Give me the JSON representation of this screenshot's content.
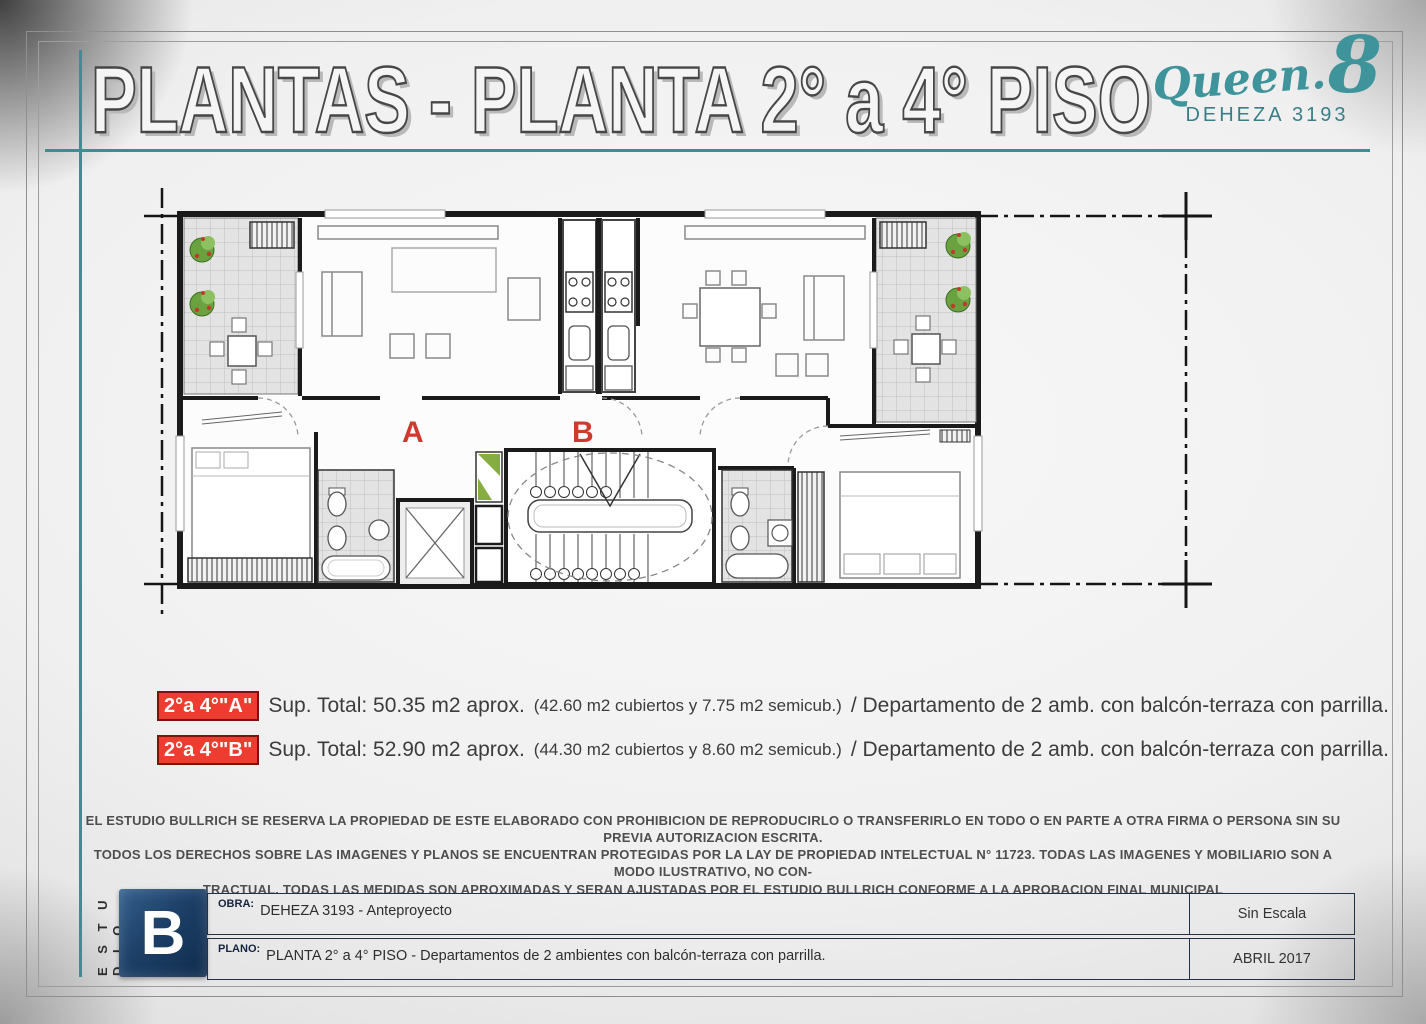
{
  "header": {
    "title": "PLANTAS - PLANTA 2° a 4° PISO",
    "accent_color": "#3c8e94",
    "logo": {
      "brand_script": "Queen.",
      "brand_number": "8",
      "subtitle": "DEHEZA 3193",
      "brand_color": "#3f949b"
    }
  },
  "plan": {
    "unit_a_label": "A",
    "unit_b_label": "B",
    "label_color": "#cf3a2e"
  },
  "summary": {
    "badge_color": "#ef3c30",
    "rows": [
      {
        "badge": "2°a 4°\"A\"",
        "main": "Sup. Total: 50.35 m2 aprox.",
        "paren": "(42.60 m2 cubiertos y 7.75 m2 semicub.)",
        "rest": "/ Departamento de 2 amb. con balcón-terraza con parrilla."
      },
      {
        "badge": "2°a 4°\"B\"",
        "main": "Sup. Total: 52.90 m2 aprox.",
        "paren": "(44.30 m2 cubiertos y 8.60 m2 semicub.)",
        "rest": "/ Departamento de 2 amb. con balcón-terraza con parrilla."
      }
    ]
  },
  "disclaimer": {
    "line1": "EL ESTUDIO BULLRICH SE RESERVA LA PROPIEDAD DE ESTE ELABORADO CON PROHIBICION DE REPRODUCIRLO O TRANSFERIRLO EN TODO O EN PARTE A OTRA FIRMA O PERSONA SIN SU PREVIA AUTORIZACION ESCRITA.",
    "line2": "TODOS LOS DERECHOS SOBRE LAS IMAGENES Y PLANOS SE ENCUENTRAN PROTEGIDAS POR LA LAY DE PROPIEDAD INTELECTUAL N° 11723.  TODAS LAS IMAGENES Y MOBILIARIO SON A MODO ILUSTRATIVO, NO CON-",
    "line3": "TRACTUAL. TODAS LAS MEDIDAS SON APROXIMADAS Y SERAN AJUSTADAS POR EL ESTUDIO BULLRICH CONFORME A LA APROBACION FINAL MUNICIPAL"
  },
  "titleblock": {
    "studio_vertical": "E S T U D I O",
    "logo_letter": "B",
    "logo_color": "#1d4068",
    "obra_label": "OBRA:",
    "obra_value": "DEHEZA 3193 - Anteproyecto",
    "plano_label": "PLANO:",
    "plano_value": "PLANTA  2° a 4°  PISO - Departamentos  de 2 ambientes con balcón-terraza con parrilla.",
    "scale": "Sin Escala",
    "date": "ABRIL 2017"
  }
}
